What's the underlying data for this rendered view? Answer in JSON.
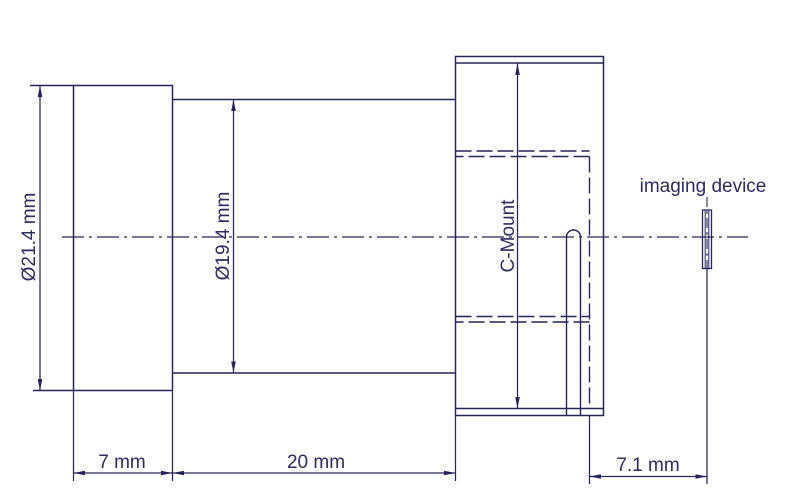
{
  "drawing": {
    "type": "technical-drawing",
    "subject": "lens with C-Mount and imaging device"
  },
  "colors": {
    "line": "#26265a",
    "text": "#2e2d5f",
    "background": "#ffffff"
  },
  "labels": {
    "flange_diameter": "Ø21.4 mm",
    "barrel_diameter": "Ø19.4 mm",
    "mount": "C-Mount",
    "flange_length": "7 mm",
    "barrel_length": "20 mm",
    "back_distance": "7.1 mm",
    "imaging_device": "imaging device"
  }
}
